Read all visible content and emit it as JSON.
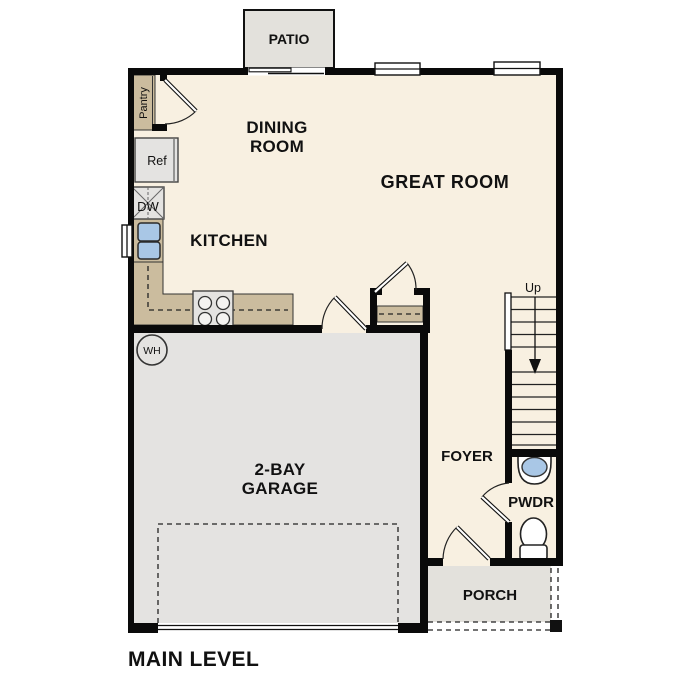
{
  "title": "MAIN LEVEL",
  "plan": {
    "patio": "PATIO",
    "dining": [
      "DINING",
      "ROOM"
    ],
    "great_room": "GREAT ROOM",
    "kitchen": "KITCHEN",
    "garage": [
      "2-BAY",
      "GARAGE"
    ],
    "foyer": "FOYER",
    "pwdr": "PWDR",
    "porch": "PORCH",
    "stairs_up": "Up",
    "pantry": "Pantry",
    "ref": "Ref",
    "dw": "DW",
    "wh": "WH"
  },
  "colors": {
    "floor": "#f8f0e1",
    "garage": "#e4e3e1",
    "concrete": "#e3e1dc",
    "counter": "#cbbc9e",
    "sink": "#a9c7e6",
    "wall": "#0a0a0a"
  }
}
